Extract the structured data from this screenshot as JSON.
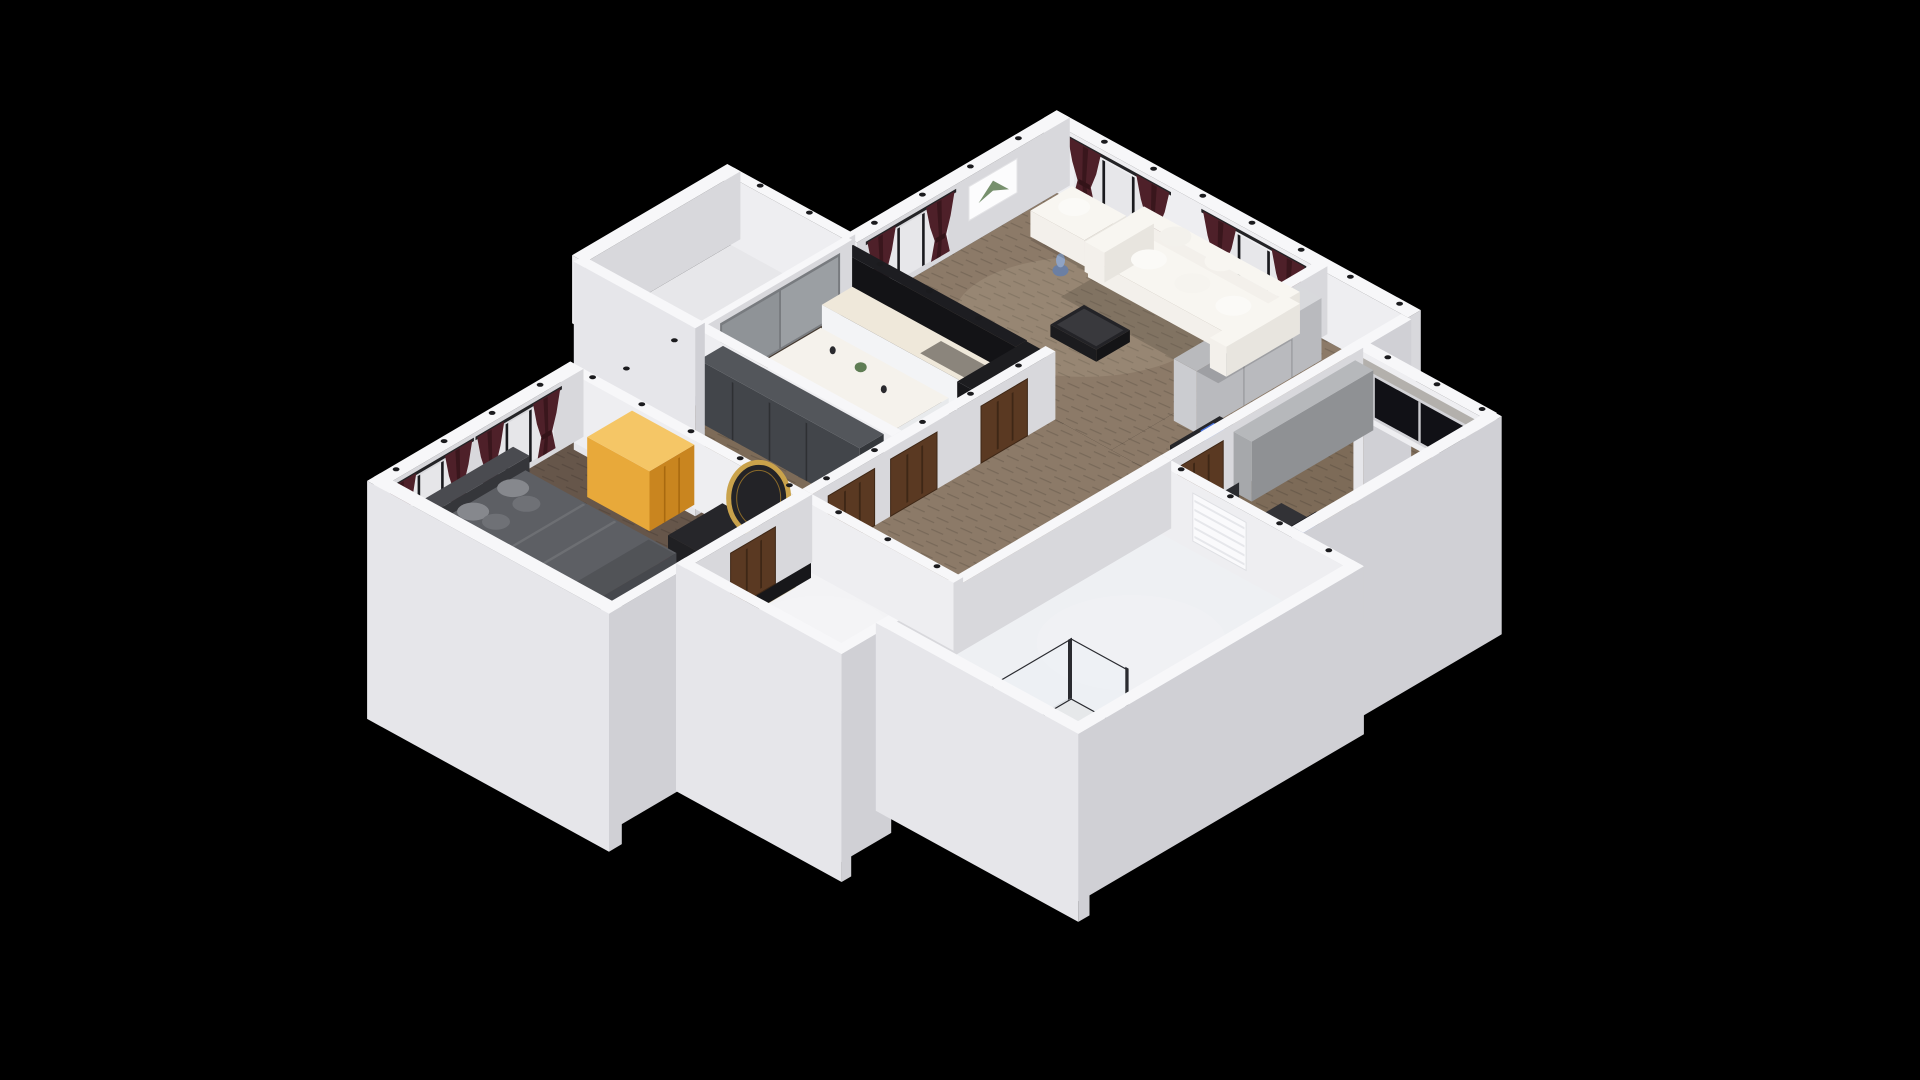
{
  "meta": {
    "description": "3D dollhouse-style cutaway render of an apartment floor plan viewed isometrically from above, centered on a black background",
    "view": "3d-dollhouse-isometric",
    "background": "#000000"
  },
  "rooms": [
    {
      "id": "living-room",
      "label": "living room with white sofa, maroon curtains, wall art and black marble TV wall"
    },
    {
      "id": "kitchen",
      "label": "kitchen with white island, counters and dark marble feature wall"
    },
    {
      "id": "balcony",
      "label": "balcony behind gray glass door"
    },
    {
      "id": "entry-hall",
      "label": "entry corridor with wardrobe and dark console"
    },
    {
      "id": "study",
      "label": "study with dark window, desk, monitor and office chair"
    },
    {
      "id": "second-bedroom",
      "label": "second bedroom with dark wardrobe, window and armchair"
    },
    {
      "id": "hallway",
      "label": "hallway with brown wooden doors"
    },
    {
      "id": "bathroom",
      "label": "white bathroom with towel radiator and glass shower"
    },
    {
      "id": "closet",
      "label": "small bright white closet room"
    },
    {
      "id": "master-bedroom",
      "label": "master bedroom with gray bed, curtained windows, gold cabinet, black vanity and round gold mirror"
    }
  ],
  "furniture": [
    "sofa",
    "loveseat",
    "coffee-table",
    "vase",
    "wall-art",
    "tv-wall",
    "kitchen-counter",
    "kitchen-island",
    "tall-cabinet",
    "glass-door",
    "entry-wardrobe",
    "console-table",
    "study-wardrobe",
    "study-desk",
    "monitor",
    "office-chair",
    "wardrobe",
    "armchair",
    "gold-cabinet",
    "vanity-table",
    "round-mirror",
    "stool",
    "double-bed",
    "pillows",
    "rug",
    "nightstand",
    "table-lamp",
    "shower-enclosure",
    "towel-radiator",
    "interior-door",
    "downlight",
    "curtains",
    "window"
  ],
  "colors": {
    "background": "#000000",
    "wallTop": "#f7f7f9",
    "faceSE": "#d8d8dc",
    "faceSW": "#eeeef1",
    "flapSE": "#d0d0d5",
    "flapSW": "#e6e6ea",
    "floorLiving": "#8c7a68",
    "floorStudy": "#7d6b58",
    "floorBedroom": "#66564a",
    "floorKitchen": "#453b32",
    "floorBath": "#eef0f3",
    "floorBalcony": "#e7e7ea",
    "floorCloset": "#f3f3f5",
    "woodLine": "rgba(0,0,0,0.14)",
    "curtain": "#4e2029",
    "curtainFold": "#331318",
    "rod": "#232326",
    "glassLight": "#e7e7ea",
    "mullion": "#1a1a1e",
    "windowDark": "#111116",
    "doorWood": "#5a3922",
    "doorWoodDark": "#3e2716",
    "marbleSide": "#131316",
    "marbleTop": "#1d1d21",
    "sofaSide": "#e8e5df",
    "sofaFront": "#f3f0eb",
    "sofaTop": "#f8f6f1",
    "counterSide": "#e8eaec",
    "counterFront": "#f3f4f6",
    "counterTop": "#efe8da",
    "islandTop": "#f5f2ec",
    "bedSide": "#46484d",
    "bedFront": "#54565b",
    "bedTop": "#5d5f64",
    "headboard": "#35363a",
    "pillowA": "#86888d",
    "pillowB": "#6f7176",
    "rugBase": "#d8cdb6",
    "rugLine": "#b9a98a",
    "goldSide": "#c9851f",
    "goldFront": "#e8a93a",
    "goldTop": "#f5c666",
    "wardrobeSide": "#34373b",
    "wardrobeFront": "#42454a",
    "wardrobeTop": "#53565b",
    "studyWardSide": "#8f9194",
    "studyWardFront": "#a6a8ab",
    "studyWardTop": "#b6b8bb",
    "deskSide": "#232326",
    "deskFront": "#2b2b2f",
    "deskTop": "#323236",
    "screenBlue": "#18233f",
    "screenGlow": "#3a64d6",
    "accentGray": "#b3b0ac",
    "dark": "#161619",
    "charcoal": "#202024",
    "gold": "#c9a24b",
    "stoolRed": "#5e2b30",
    "plantGreen": "#5f7d54",
    "vaseBlue": "#6b7fa3",
    "vaseBlueLight": "#8fa3c4",
    "blueDecor": "#3a64d6",
    "downlight": "#1b1b1e",
    "glassShower": "rgba(235,240,246,0.35)",
    "showerFrame": "#2a2b30",
    "showerTray": "#e6e8ea",
    "entryWardSide": "#b9babe",
    "entryWardFront": "#cbccd0",
    "entryWardTop": "#d8d9dc",
    "glowWarm": "rgba(255,243,219,0.10)",
    "glowWhite": "rgba(255,255,255,0.12)",
    "shadow": "rgba(0,0,0,0.14)"
  }
}
